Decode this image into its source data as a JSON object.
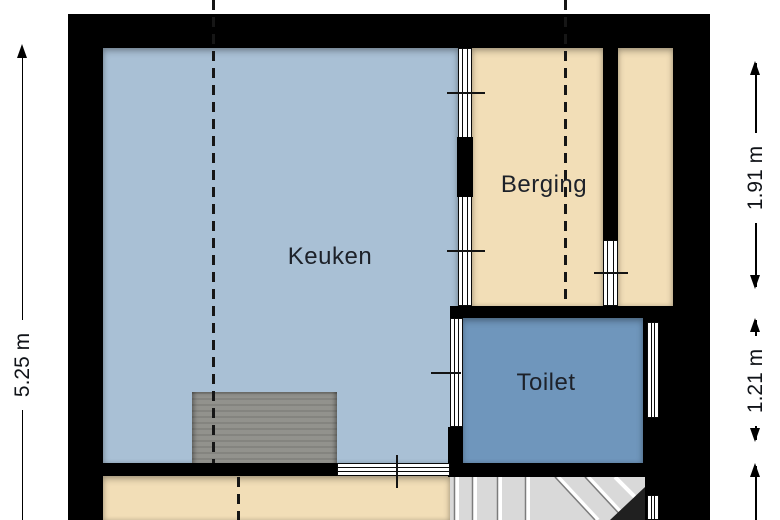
{
  "plan": {
    "type": "floorplan",
    "rooms": [
      {
        "name": "Keuken",
        "floor_color": "#a9c0d5"
      },
      {
        "name": "Berging",
        "floor_color": "#f2deb7"
      },
      {
        "name": "Toilet",
        "floor_color": "#6f96bc"
      }
    ],
    "dimensions": [
      {
        "label": "5.25 m",
        "side": "left"
      },
      {
        "label": "1.91 m",
        "side": "right-top"
      },
      {
        "label": "1.21 m",
        "side": "right-middle"
      }
    ],
    "colors": {
      "wall": "#000000",
      "canvas": "#ffffff",
      "counter": "#8e8e89",
      "stairs_fill": "#d9d9d9",
      "stairs_dark": "#202020",
      "hall_floor": "#f2deb7",
      "label_text": "#1d2129"
    }
  }
}
